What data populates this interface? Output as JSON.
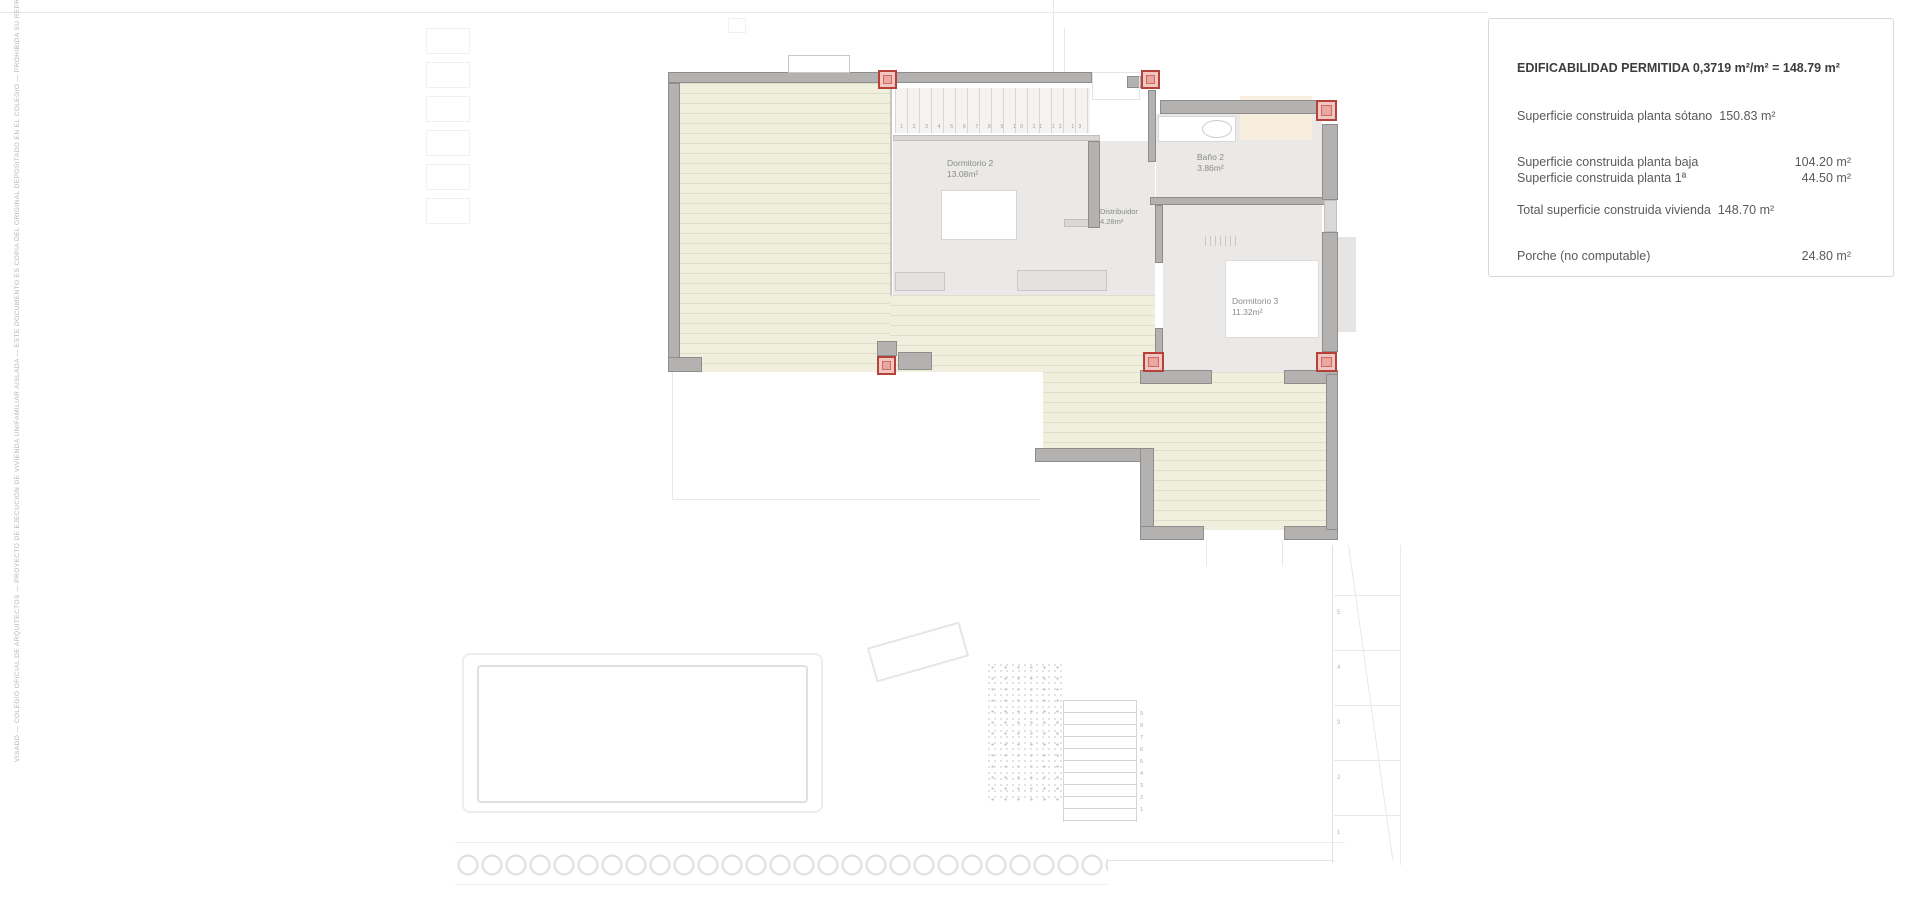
{
  "info_panel": {
    "title": "EDIFICABILIDAD PERMITIDA 0,3719 m²/m² = 148.79 m²",
    "rows": [
      {
        "label": "Superficie construida planta sótano",
        "value": "150.83 m²"
      },
      {
        "label": "Superficie construida planta baja",
        "value": "104.20 m²"
      },
      {
        "label": "Superficie construida planta 1ª",
        "value": "44.50 m²"
      },
      {
        "label": "Total superficie construida vivienda",
        "value": "148.70 m²"
      },
      {
        "label": "Porche (no computable)",
        "value": "24.80 m²"
      }
    ]
  },
  "rooms": {
    "dormitorio2": {
      "name": "Dormitorio 2",
      "area": "13.08m²"
    },
    "bano2": {
      "name": "Baño 2",
      "area": "3.86m²"
    },
    "distribuidor": {
      "name": "Distribuidor",
      "area": "4.28m²"
    },
    "dormitorio3": {
      "name": "Dormitorio 3",
      "area": "11.32m²"
    }
  },
  "annotations": {
    "stair_numbers": "1 2 3 4 5 6 7 8 9 10 11 12 13 14 15 16",
    "garden_step_numbers": "9\n8\n7\n6\n5\n4\n3\n2\n1",
    "contour_numbers": "5\n4\n3\n2\n1",
    "side_text": "VISADO — COLEGIO OFICIAL DE ARQUITECTOS — PROYECTO DE EJECUCION DE VIVIENDA UNIFAMILIAR AISLADA — ESTE DOCUMENTO ES COPIA DEL ORIGINAL DEPOSITADO EN EL COLEGIO — PROHIBIDA SU REPRODUCCION TOTAL O PARCIAL SIN AUTORIZACION EXPRESA DEL ARQUITECTO AUTOR DEL PROYECTO"
  },
  "colors": {
    "anchor_red": "#b5413a",
    "wall_gray": "#b3b2b0",
    "terrace_beige": "#f0eedd",
    "floor_gray": "#eae9e7"
  }
}
